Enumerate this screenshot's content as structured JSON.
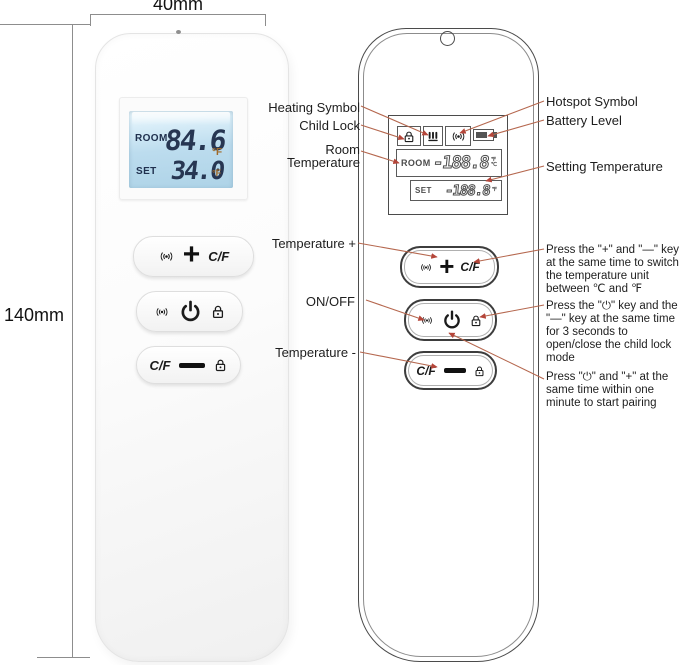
{
  "dimension_labels": {
    "width": "40mm",
    "height": "140mm"
  },
  "photo_remote": {
    "lcd": {
      "room_label": "ROOM",
      "room_value": "84.6",
      "room_unit": "°F",
      "set_label": "SET",
      "set_value": "34.0",
      "set_unit": "°F"
    },
    "buttons": {
      "plus_symbol": "+",
      "cf_label": "C/F"
    }
  },
  "diagram_remote": {
    "lcd": {
      "room_label": "ROOM",
      "room_value": "-188.8",
      "set_label": "SET",
      "set_value": "-188.8",
      "unit_f": "℉",
      "unit_c": "℃"
    },
    "buttons": {
      "plus_symbol": "+",
      "cf_label": "C/F"
    }
  },
  "callouts_left": [
    {
      "label": "Heating Symbol"
    },
    {
      "label": "Child Lock"
    },
    {
      "label": "Room Temperature"
    },
    {
      "label": "Temperature +"
    },
    {
      "label": "ON/OFF"
    },
    {
      "label": "Temperature -"
    }
  ],
  "callouts_right": [
    {
      "label": "Hotspot Symbol"
    },
    {
      "label": "Battery Level"
    },
    {
      "label": "Setting Temperature"
    }
  ],
  "instructions": [
    {
      "text": "Press the \"+\" and \"—\" key at the same time to switch the temperature unit between ℃ and ℉"
    },
    {
      "text": "Press the \"⏻\" key and the \"—\" key at the same time for 3 seconds to open/close the child lock mode"
    },
    {
      "text": "Press \"⏻\" and \"+\" at the same time within one minute to start pairing"
    }
  ],
  "icons": {
    "broadcast": "broadcast-signal-icon",
    "power": "power-icon",
    "lock": "child-lock-icon",
    "heating": "heating-icon",
    "battery": "battery-icon"
  },
  "colors": {
    "leader_line": "#b5674e",
    "arrow": "#b5463a",
    "lcd_backlight": "#bcdcee",
    "lcd_digits": "#273652",
    "lcd_unit_accent": "#a06a28",
    "diagram_outline": "#4b4b4b"
  }
}
